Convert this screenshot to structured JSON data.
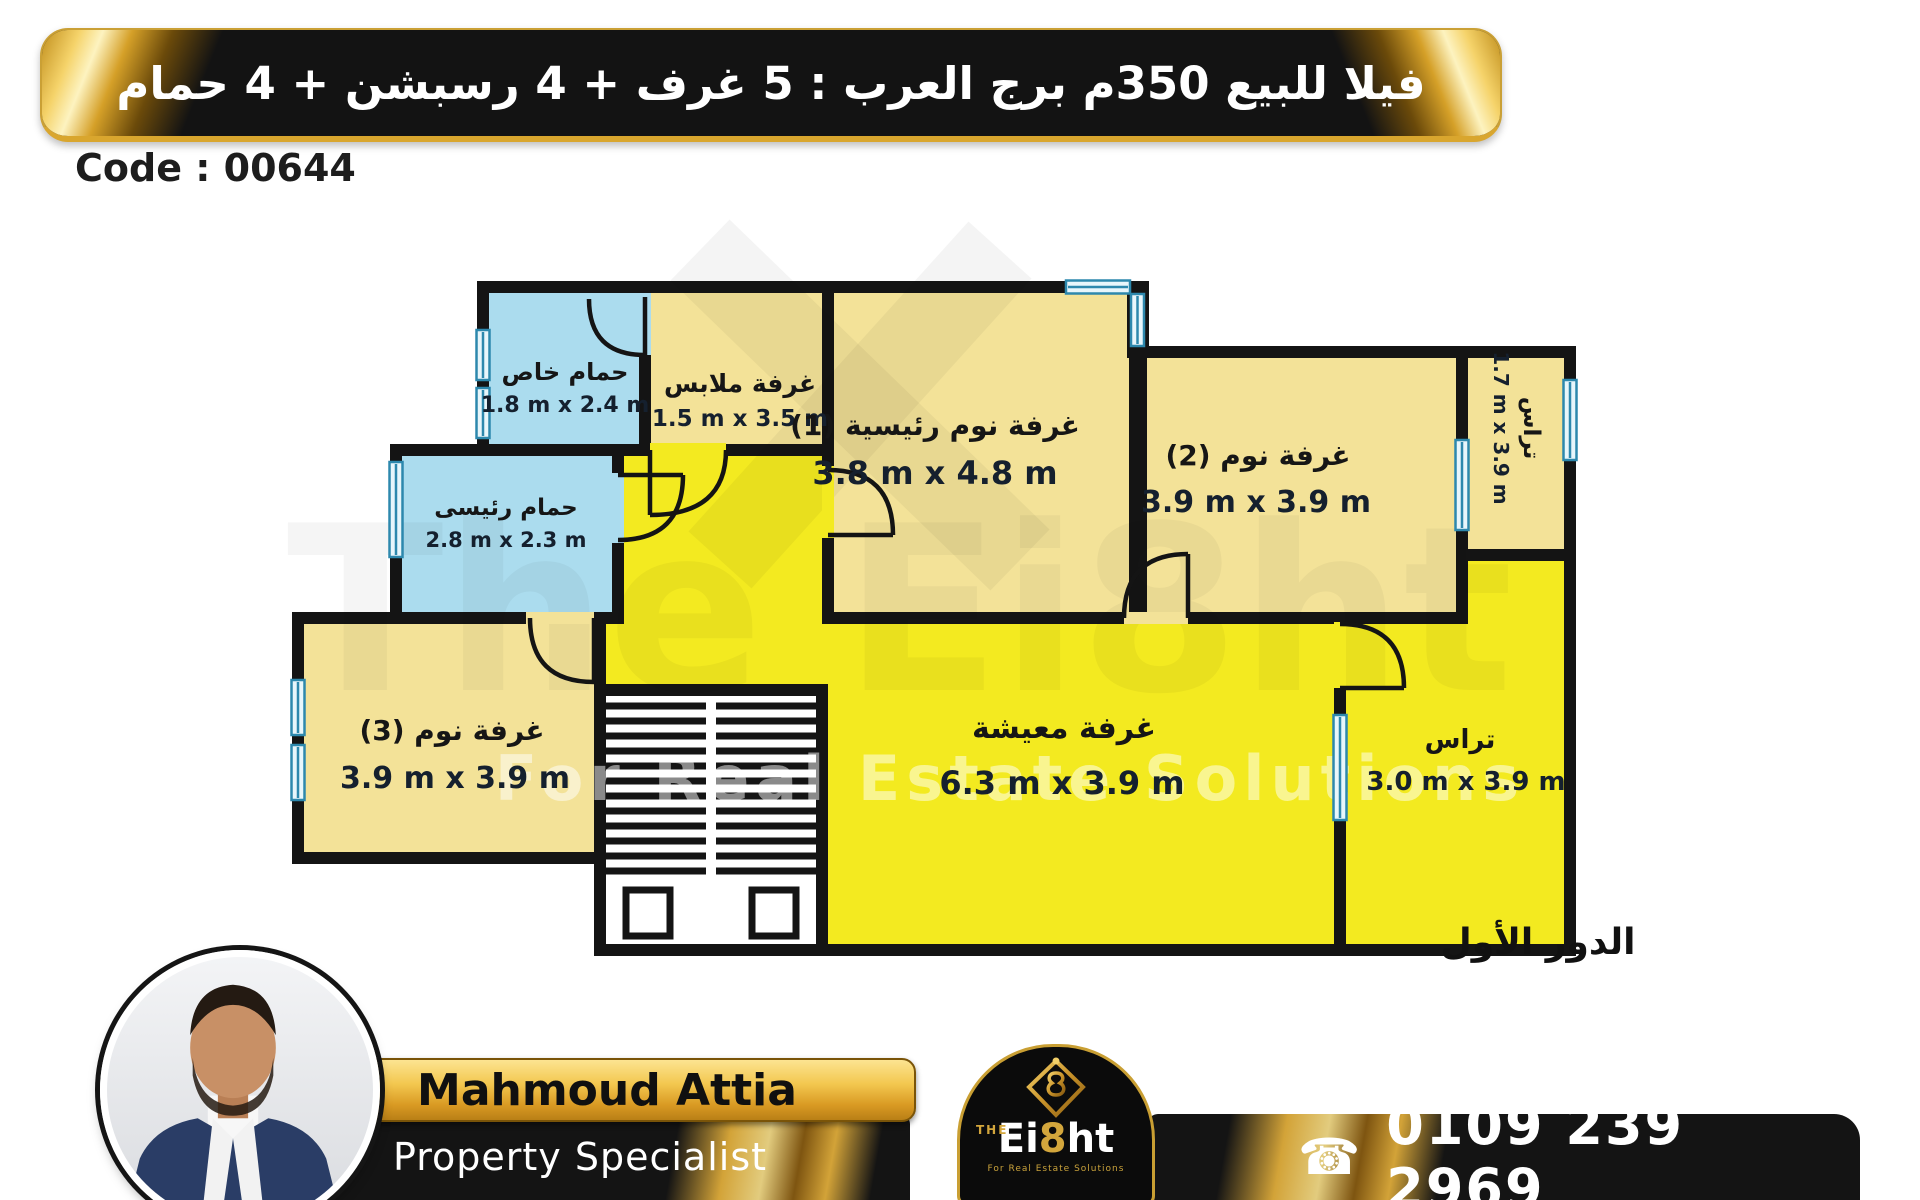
{
  "header": {
    "title": "فيلا للبيع 350م برج العرب : 5 غرف + 4 رسبشن + 4 حمام"
  },
  "code_label": "Code : 00644",
  "floor_label": "الدور الأول",
  "plan": {
    "rooms": [
      {
        "id": "bath_private",
        "name": "حمام خاص",
        "dims": "1.8 m x 2.4 m"
      },
      {
        "id": "dressing",
        "name": "غرفة ملابس",
        "dims": "1.5 m x 3.5 m"
      },
      {
        "id": "master_bedroom",
        "name": "غرفة نوم رئيسية (1)",
        "dims": "3.8 m x 4.8 m"
      },
      {
        "id": "bedroom_2",
        "name": "غرفة نوم (2)",
        "dims": "3.9 m x 3.9 m"
      },
      {
        "id": "terrace_side",
        "name": "تراس",
        "dims": "1.7 m x 3.9 m"
      },
      {
        "id": "bath_main",
        "name": "حمام رئيسى",
        "dims": "2.8 m x 2.3 m"
      },
      {
        "id": "bedroom_3",
        "name": "غرفة نوم (3)",
        "dims": "3.9 m x 3.9 m"
      },
      {
        "id": "living",
        "name": "غرفة معيشة",
        "dims": "6.3 m x 3.9 m"
      },
      {
        "id": "terrace_back",
        "name": "تراس",
        "dims": "3.0 m x 3.9 m"
      }
    ],
    "colors": {
      "room_pale": "#f3e298",
      "room_bright": "#f3ea20",
      "room_blue": "#abdcee",
      "wall": "#141414",
      "window": "#2d88ad"
    }
  },
  "watermark": {
    "line1": "The Ei8ht",
    "line2": "For Real Estate Solutions"
  },
  "footer": {
    "agent_name": "Mahmoud Attia",
    "agent_title": "Property Specialist",
    "phone": "0109 239 2969",
    "phone_icon": "☎",
    "logo": {
      "the": "THE",
      "part1": "Ei",
      "part2": "8",
      "part3": "ht",
      "tagline": "For Real Estate Solutions"
    }
  }
}
